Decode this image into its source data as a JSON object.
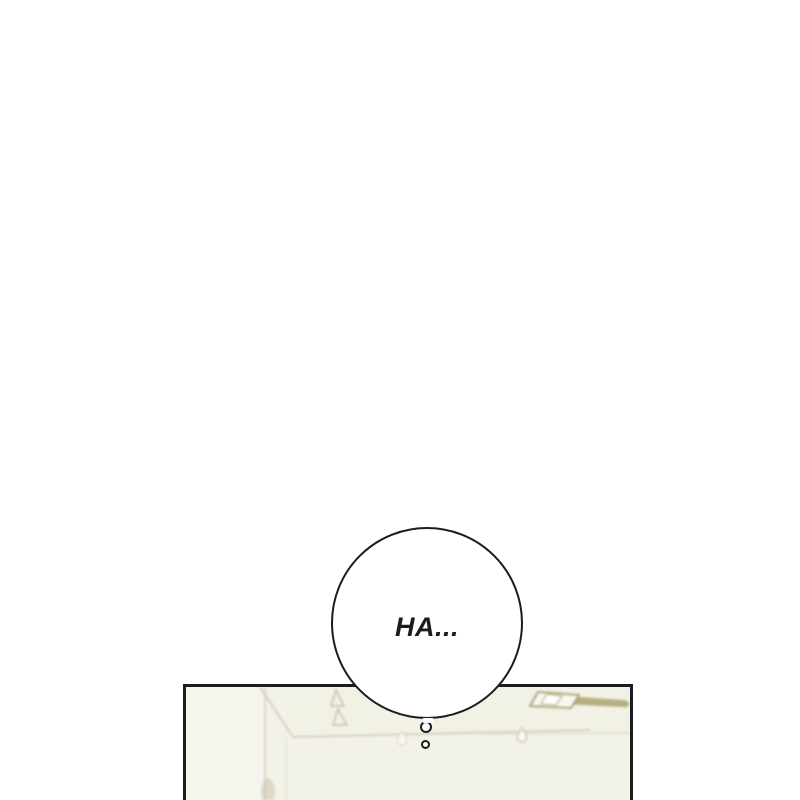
{
  "colors": {
    "background": "#ffffff",
    "ink": "#1c1c1c",
    "panel_background": "#f3f2e9",
    "ceiling_light_khaki": "#b7ae7f",
    "faint_line": "#d5d1bd"
  },
  "speech_bubble": {
    "text": "HA..."
  },
  "panel": {
    "detail_icons": [
      "ceiling-light-icon",
      "wall-corner-lines",
      "picture-rail-line",
      "wall-hooks-icon",
      "hanging-drop-icon"
    ]
  }
}
